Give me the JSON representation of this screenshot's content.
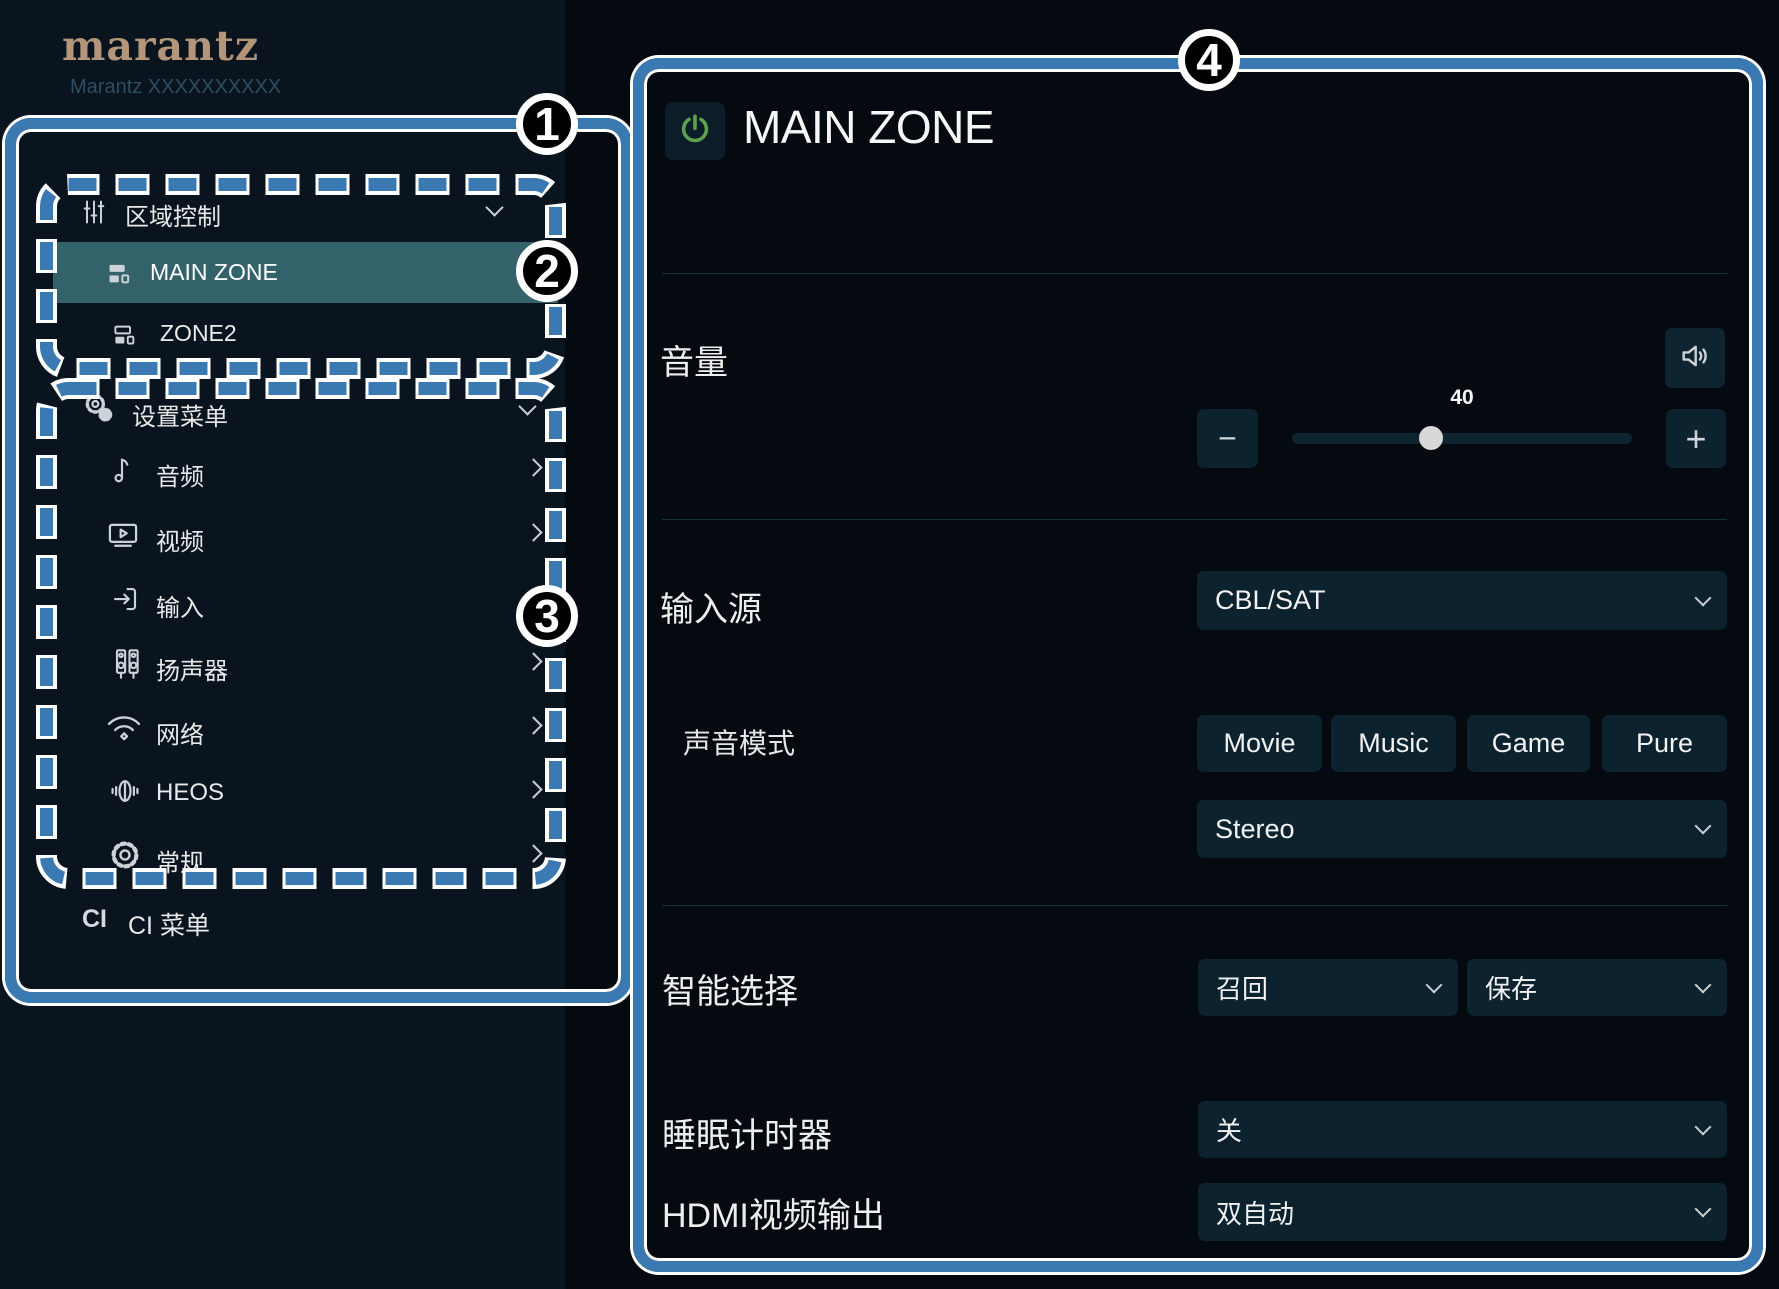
{
  "sidebar": {
    "logo": "marantz",
    "device_name": "Marantz XXXXXXXXXX",
    "zone_section": {
      "title": "区域控制",
      "title_icon": "sliders-icon",
      "items": [
        {
          "label": "MAIN ZONE",
          "icon": "zone-icon",
          "selected": true
        },
        {
          "label": "ZONE2",
          "icon": "zone-icon",
          "selected": false
        }
      ]
    },
    "setup_section": {
      "title": "设置菜单",
      "title_icon": "gears-icon",
      "items": [
        {
          "label": "音频",
          "icon": "music-note-icon"
        },
        {
          "label": "视频",
          "icon": "tv-icon"
        },
        {
          "label": "输入",
          "icon": "input-icon"
        },
        {
          "label": "扬声器",
          "icon": "speakers-icon"
        },
        {
          "label": "网络",
          "icon": "wifi-icon"
        },
        {
          "label": "HEOS",
          "icon": "heos-icon"
        },
        {
          "label": "常规",
          "icon": "gear-icon"
        }
      ]
    },
    "ci": {
      "abbr": "CI",
      "label": "CI 菜单"
    }
  },
  "main": {
    "title": "MAIN ZONE",
    "power_icon": "power-icon",
    "volume": {
      "label": "音量",
      "value": "40",
      "minus": "−",
      "plus": "+",
      "mute_icon": "speaker-wave-icon"
    },
    "input_source": {
      "label": "输入源",
      "value": "CBL/SAT"
    },
    "sound_mode": {
      "label": "声音模式",
      "modes": [
        "Movie",
        "Music",
        "Game",
        "Pure"
      ],
      "current": "Stereo"
    },
    "smart_select": {
      "label": "智能选择",
      "recall_label": "召回",
      "save_label": "保存"
    },
    "sleep_timer": {
      "label": "睡眠计时器",
      "value": "关"
    },
    "hdmi_output": {
      "label": "HDMI视频输出",
      "value": "双自动"
    }
  },
  "annotations": {
    "badges": [
      "1",
      "2",
      "3",
      "4"
    ],
    "accent_color": "#3b79b3"
  },
  "colors": {
    "sidebar_bg": "#0a141f",
    "main_bg": "#050a10",
    "selected_zone_bg": "#33626b",
    "control_bg": "#0c222e",
    "callout_blue": "#3b79b3",
    "power_green": "#5ca24e",
    "logo_tan": "#b3957a"
  }
}
